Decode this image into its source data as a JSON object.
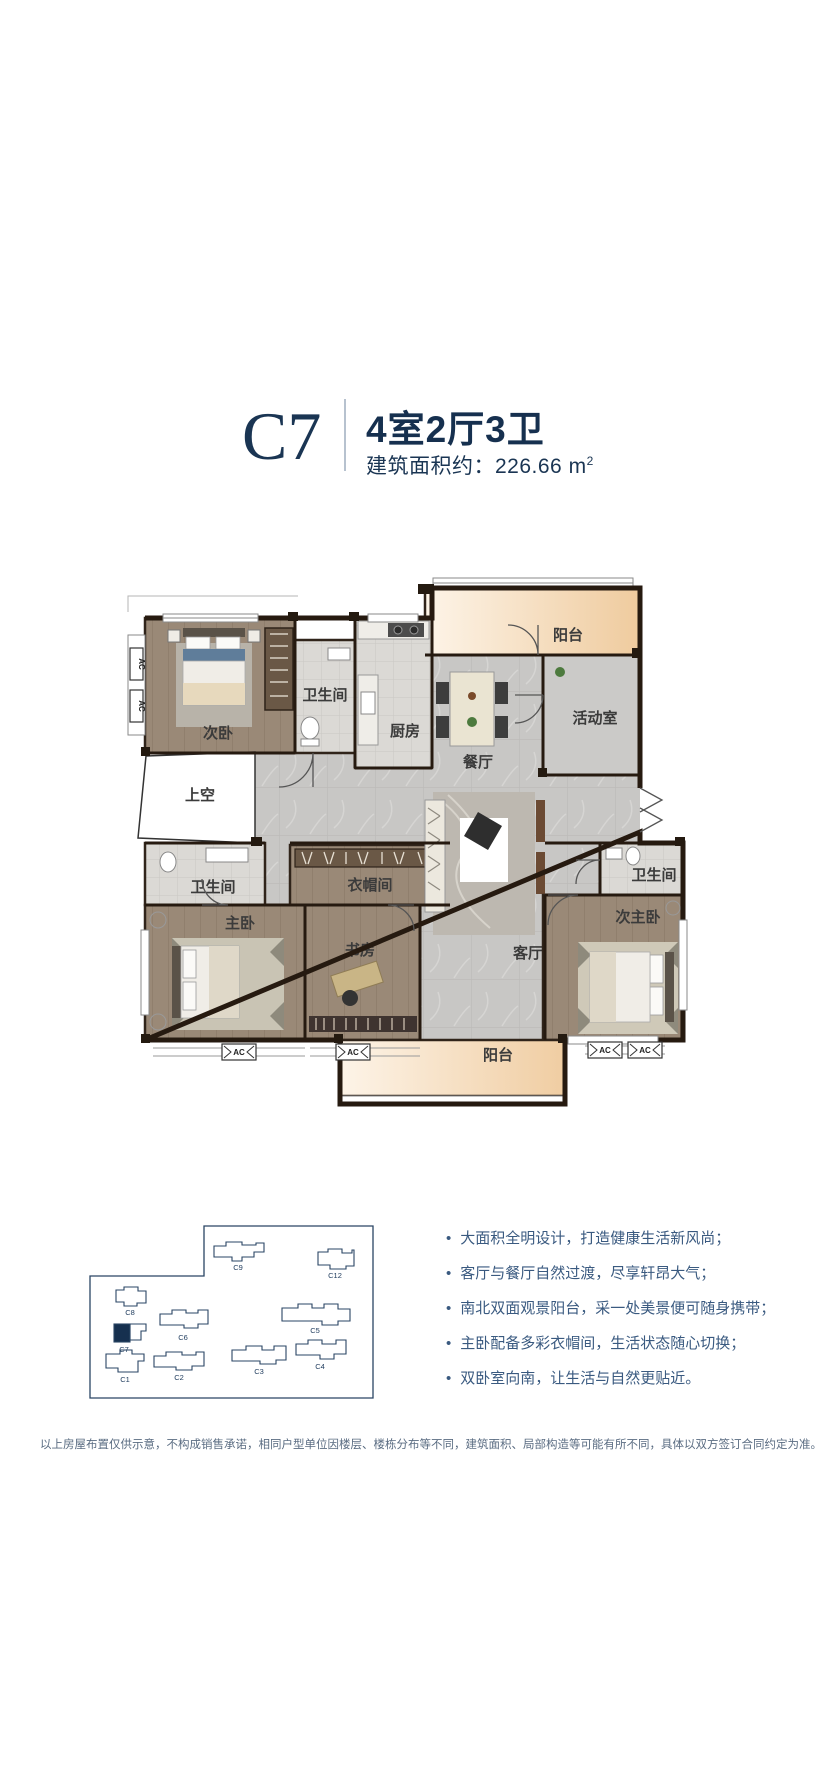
{
  "header": {
    "unit_code": "C7",
    "layout_title": "4室2厅3卫",
    "area_label": "建筑面积约：",
    "area_value": "226.66",
    "area_unit": "m",
    "area_sup": "2"
  },
  "floorplan": {
    "ac_label": "AC",
    "rooms": [
      {
        "id": "balcony-north",
        "label": "阳台"
      },
      {
        "id": "activity-room",
        "label": "活动室"
      },
      {
        "id": "second-bedroom",
        "label": "次卧"
      },
      {
        "id": "bathroom-north",
        "label": "卫生间"
      },
      {
        "id": "kitchen",
        "label": "厨房"
      },
      {
        "id": "dining-room",
        "label": "餐厅"
      },
      {
        "id": "void-space",
        "label": "上空"
      },
      {
        "id": "bathroom-master",
        "label": "卫生间"
      },
      {
        "id": "cloakroom",
        "label": "衣帽间"
      },
      {
        "id": "bathroom-east",
        "label": "卫生间"
      },
      {
        "id": "master-bedroom",
        "label": "主卧"
      },
      {
        "id": "study",
        "label": "书房"
      },
      {
        "id": "living-room",
        "label": "客厅"
      },
      {
        "id": "second-master-bedroom",
        "label": "次主卧"
      },
      {
        "id": "balcony-south",
        "label": "阳台"
      }
    ]
  },
  "siteplan": {
    "highlighted_unit": "C7",
    "buildings": [
      {
        "id": "C9",
        "label": "C9"
      },
      {
        "id": "C12",
        "label": "C12"
      },
      {
        "id": "C8",
        "label": "C8"
      },
      {
        "id": "C6",
        "label": "C6"
      },
      {
        "id": "C5",
        "label": "C5"
      },
      {
        "id": "C7",
        "label": "C7"
      },
      {
        "id": "C1",
        "label": "C1"
      },
      {
        "id": "C2",
        "label": "C2"
      },
      {
        "id": "C3",
        "label": "C3"
      },
      {
        "id": "C4",
        "label": "C4"
      }
    ]
  },
  "features": {
    "items": [
      "大面积全明设计，打造健康生活新风尚；",
      "客厅与餐厅自然过渡，尽享轩昂大气；",
      "南北双面观景阳台，采一处美景便可随身携带；",
      "主卧配备多彩衣帽间，生活状态随心切换；",
      "双卧室向南，让生活与自然更贴近。"
    ]
  },
  "disclaimer": "以上房屋布置仅供示意，不构成销售承诺，相同户型单位因楼层、楼栋分布等不同，建筑面积、局部构造等可能有所不同，具体以双方签订合同约定为准。",
  "colors": {
    "navy": "#1a3553",
    "feature_text": "#3a5a80",
    "disclaimer_text": "#5a6c82",
    "balcony_fill": "#f2d0a6",
    "wall": "#2c2014"
  }
}
